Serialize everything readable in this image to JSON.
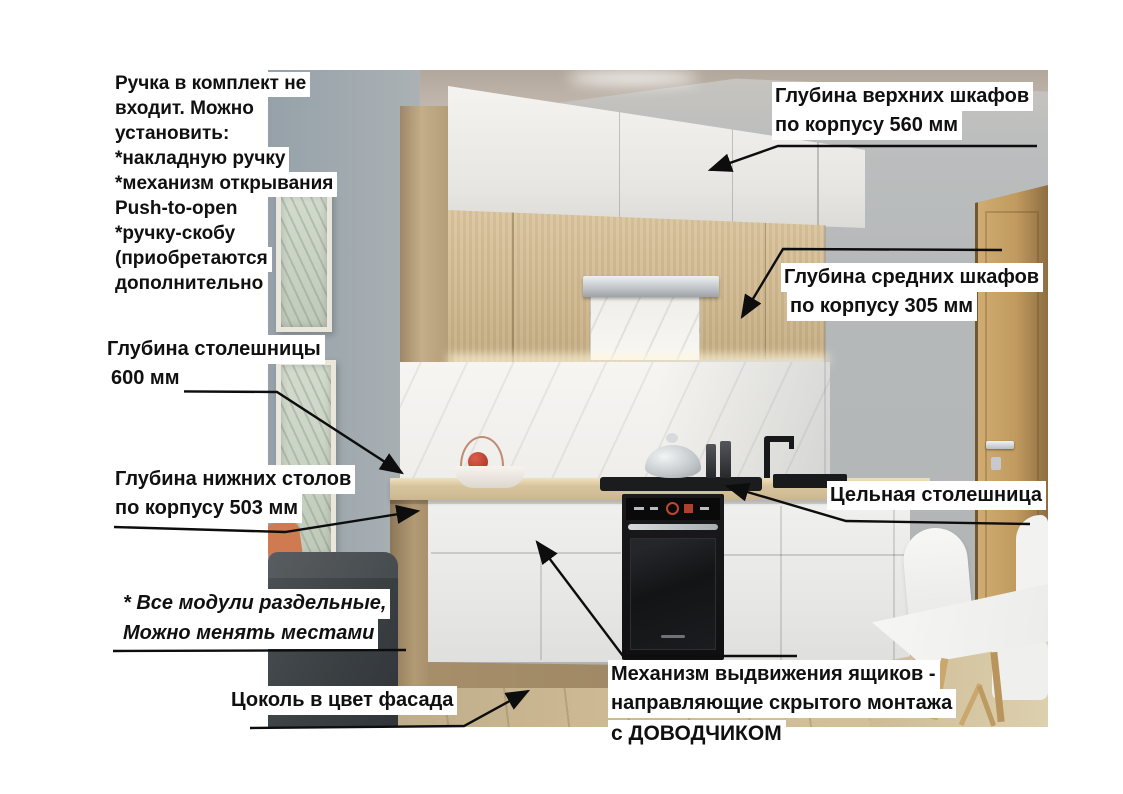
{
  "annotations": {
    "handle_note": {
      "lines": [
        "Ручка в комплект не",
        "входит. Можно",
        "установить:",
        "*накладную ручку",
        "*механизм открывания",
        "Push-to-open",
        "*ручку-скобу",
        "(приобретаются",
        "дополнительно"
      ]
    },
    "upper_cabinet_depth": {
      "lines": [
        "Глубина верхних шкафов",
        "по корпусу 560 мм"
      ]
    },
    "middle_cabinet_depth": {
      "lines": [
        "Глубина средних шкафов",
        "по корпусу 305 мм"
      ]
    },
    "countertop_depth": {
      "lines": [
        "Глубина столешницы",
        "600 мм"
      ]
    },
    "base_cabinet_depth": {
      "lines": [
        "Глубина нижних столов",
        "по корпусу 503 мм"
      ]
    },
    "solid_countertop": {
      "text": "Цельная столешница"
    },
    "modules_note": {
      "lines": [
        "* Все модули раздельные,",
        "Можно менять местами"
      ]
    },
    "plinth_note": {
      "text": "Цоколь в цвет фасада"
    },
    "drawer_mechanism_note": {
      "lines": [
        "Механизм выдвижения ящиков -",
        "направляющие скрытого монтажа",
        "с ДОВОДЧИКОМ"
      ]
    }
  },
  "palette": {
    "label_background": "#ffffff",
    "label_text": "#101010",
    "arrow": "#0d0d0d",
    "cabinet_wood": "#cdb68d",
    "cabinet_white": "#efefed",
    "countertop": "#d8c59e",
    "wall_gray": "#b6b9ba",
    "door_wood": "#c09a5e",
    "oven_black": "#141416",
    "sofa_gray": "#3f4447",
    "pillow_accent": "#cf7a50",
    "floor_wood": "#ccb993"
  }
}
